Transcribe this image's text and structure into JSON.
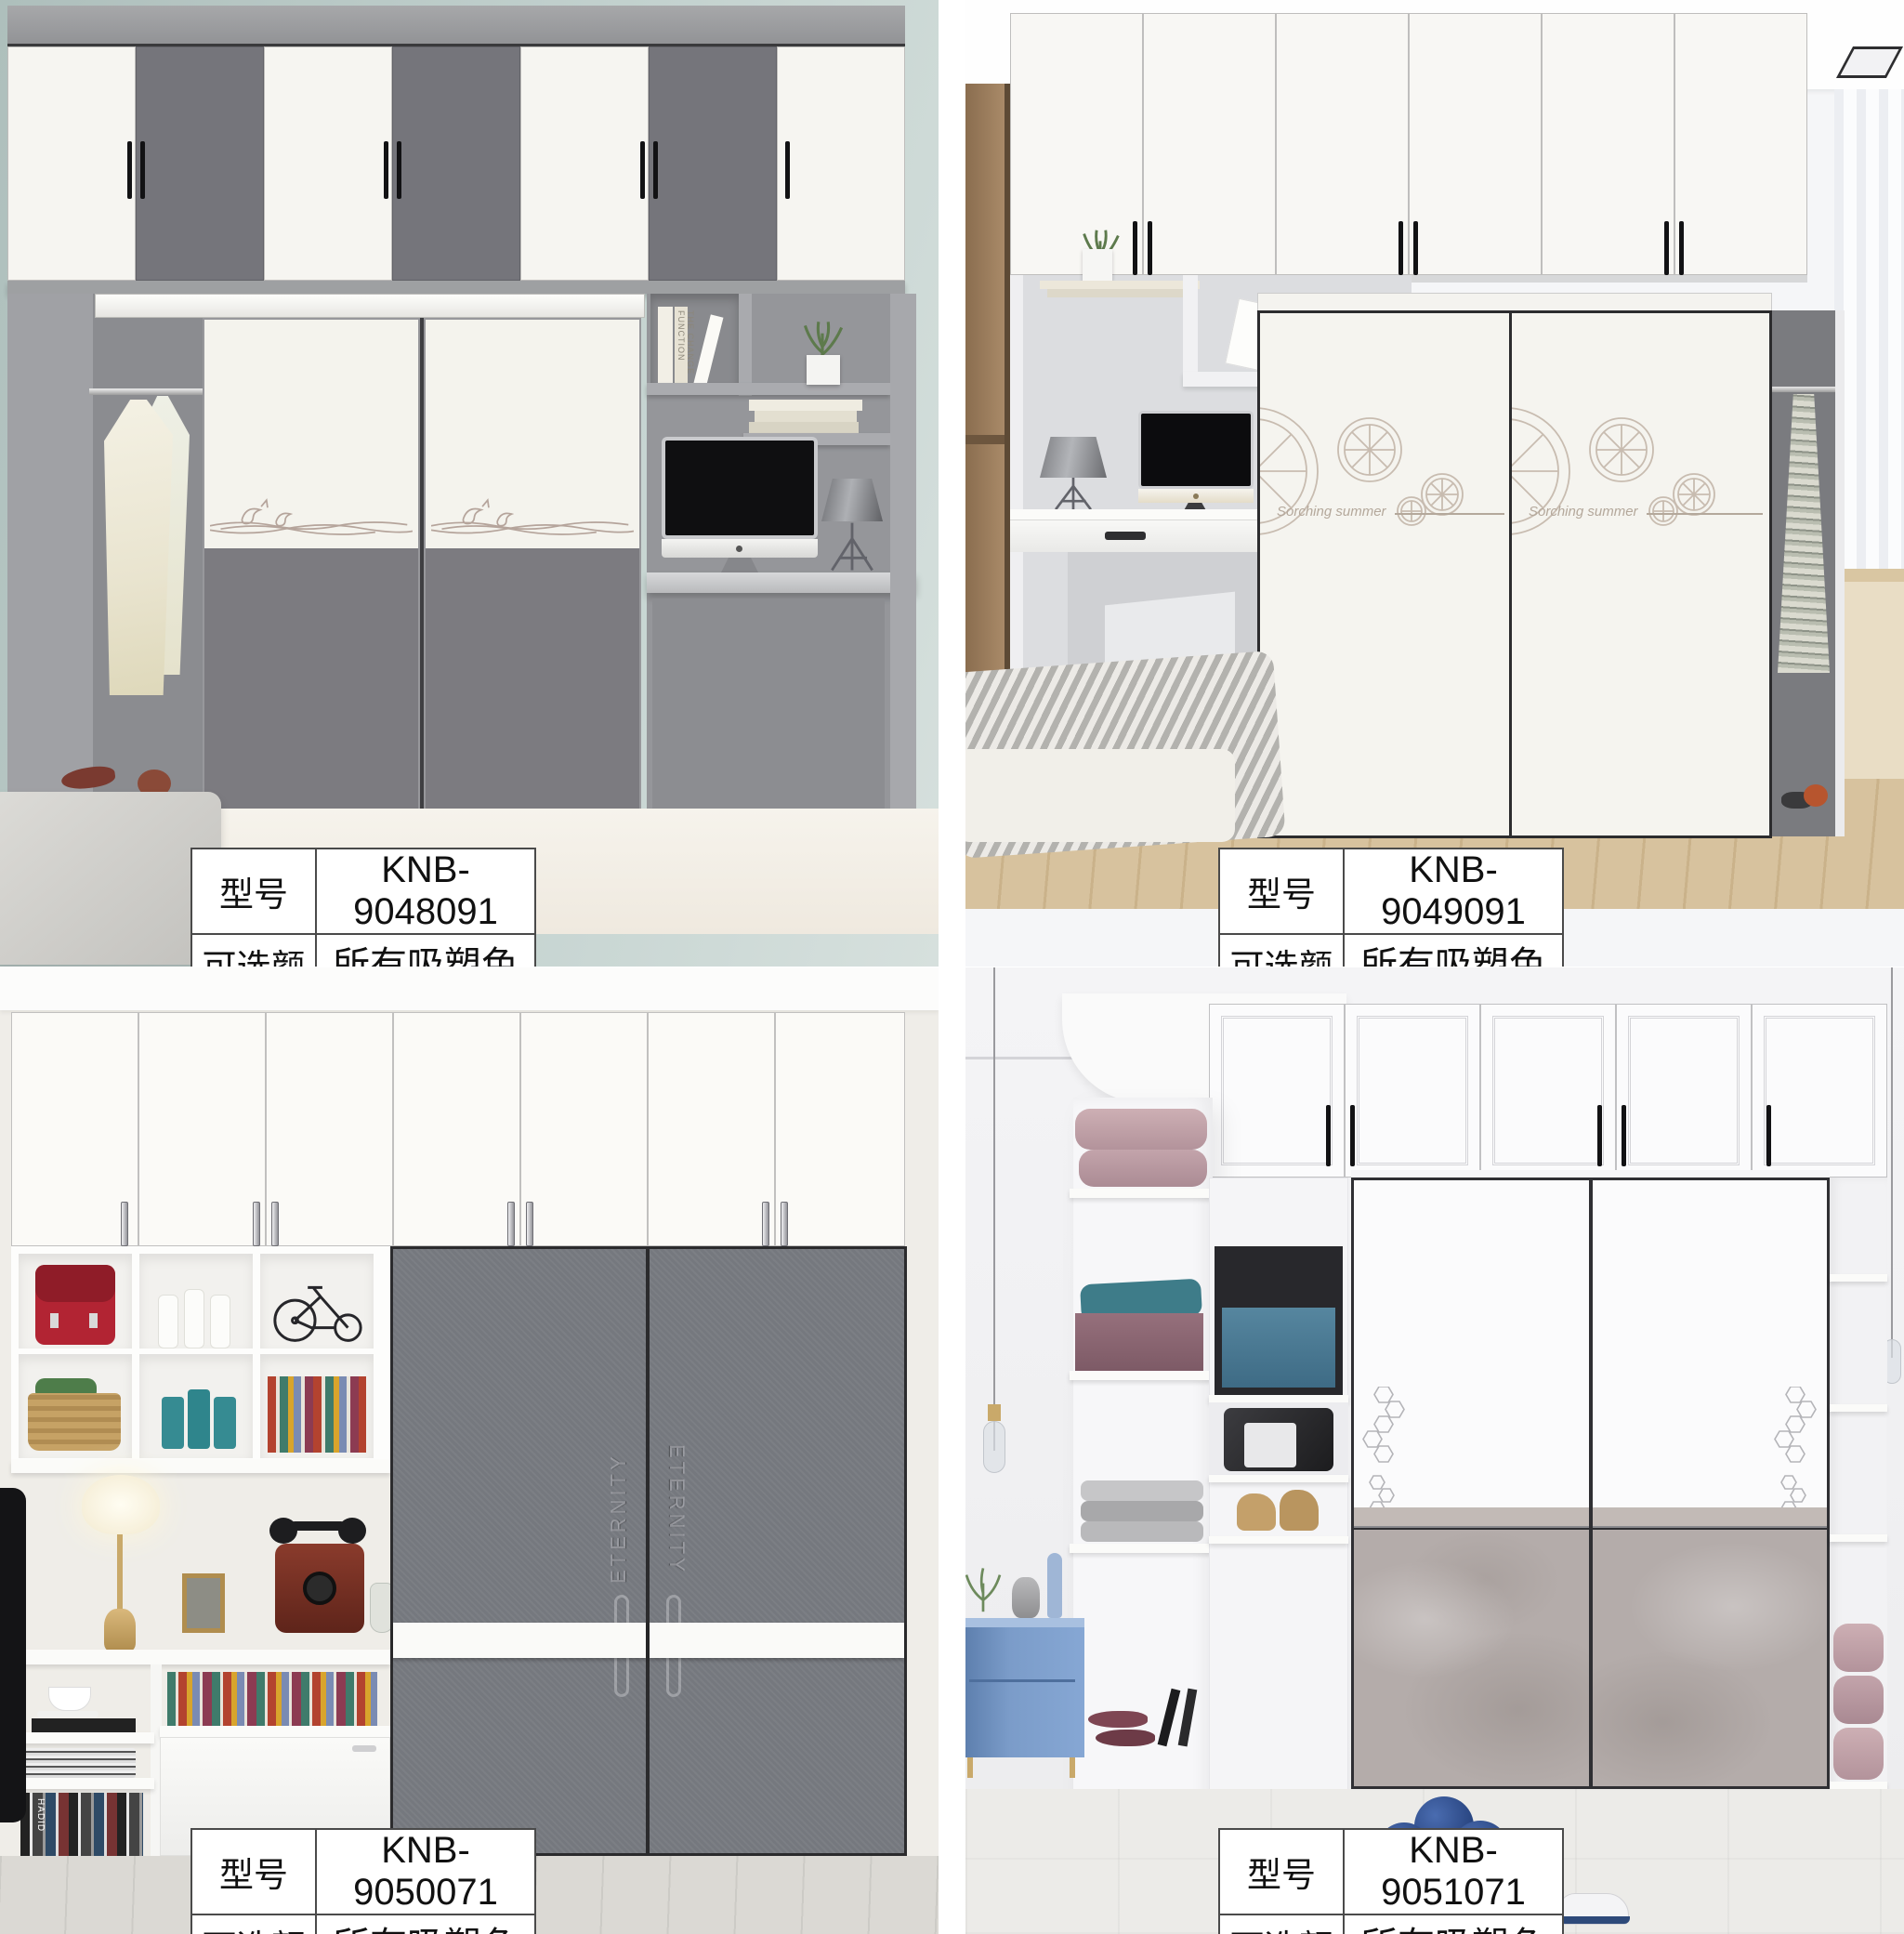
{
  "page": {
    "type": "wardrobe catalog sheet",
    "grid": "2x2",
    "background": "#ffffff"
  },
  "products": [
    {
      "model_label": "型号",
      "model_value": "KNB-9048091",
      "color_label": "可选颜色",
      "color_value": "所有吸塑色卡",
      "scene": {
        "wall": "#b7c8c4",
        "upper_doors": 7,
        "upper_door_colors": [
          "#f6f5f1",
          "#75757b"
        ],
        "sliding_doors": 2,
        "door_style": "white upper with dolphin etching, gray lower",
        "art": "dolphin-waves",
        "extras": [
          "hanging dress",
          "desk with iMac",
          "desk lamp",
          "plant",
          "books",
          "bed",
          "rug"
        ]
      }
    },
    {
      "model_label": "型号",
      "model_value": "KNB-9049091",
      "color_label": "可选颜色",
      "color_value": "所有吸塑色卡",
      "scene": {
        "wall": "#f4f4f6",
        "upper_doors": 6,
        "upper_door_colors": [
          "#f8f7f4"
        ],
        "sliding_doors": 2,
        "door_style": "white with citrus-slice etching",
        "art": "citrus-slices",
        "door_caption": "Sorching summer",
        "extras": [
          "desk with iMac",
          "desk lamp",
          "drawer",
          "plant",
          "books",
          "hanging clothes",
          "striped bed",
          "curtain",
          "ceiling light"
        ]
      }
    },
    {
      "model_label": "型号",
      "model_value": "KNB-9050071",
      "color_label": "可选颜色",
      "color_value": "所有吸塑色卡",
      "scene": {
        "wall": "#efede8",
        "upper_doors": 7,
        "upper_door_colors": [
          "#fbfaf7"
        ],
        "sliding_doors": 2,
        "door_style": "gray textured doors with white horizontal band",
        "door_text": "ETERNITY",
        "extras": [
          "cubby shelves",
          "red backpack",
          "vases",
          "bicycle model",
          "basket",
          "canisters",
          "books",
          "table lamp",
          "antique telephone",
          "photo frame",
          "magazines",
          "white cabinet"
        ]
      }
    },
    {
      "model_label": "型号",
      "model_value": "KNB-9051071",
      "color_label": "可选颜色",
      "color_value": "所有吸塑色卡",
      "scene": {
        "wall": "#f2f2f4",
        "upper_doors": 5,
        "upper_door_colors": [
          "#fbfbfc"
        ],
        "sliding_doors": 2,
        "door_style": "white upper with hexagon etching, concrete-gray lower",
        "art": "hexagons",
        "extras": [
          "curved shelf tower",
          "pink pillows",
          "teal cloth box",
          "towels",
          "blue nightstand",
          "vases",
          "pendant lights",
          "blue storage box",
          "handbag",
          "shoes",
          "blue roses",
          "sneaker"
        ]
      }
    }
  ],
  "decorative_text": {
    "book_spine": "THE CHANGE FUNCTION",
    "magazine_spine": "HADID",
    "q2_door_caption": "Sorching summer",
    "q3_door_text": "ETERNITY"
  },
  "palette": {
    "cabinet_gray": "#75757b",
    "slide_door_gray": "#76797e",
    "concrete": "#b4acaa",
    "sage_wall": "#b7c8c4",
    "wood_side": "#9a7d5e",
    "nightstand_blue": "#7195c5",
    "table_border": "#4a4a4a",
    "etch_line": "#b5a49b"
  }
}
